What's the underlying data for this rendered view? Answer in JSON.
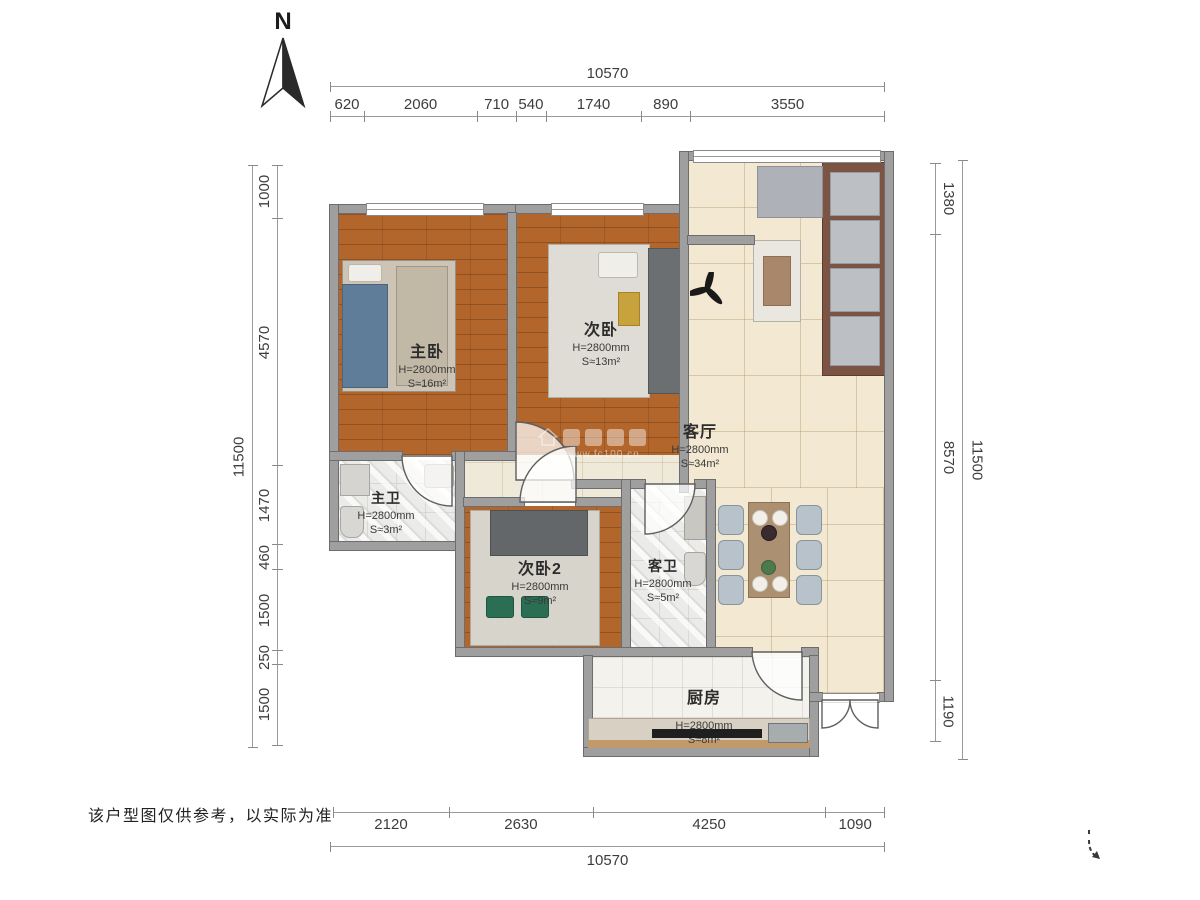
{
  "north": {
    "label": "N"
  },
  "disclaimer": "该户型图仅供参考，以实际为准",
  "watermark": {
    "url": "www.fc100.cn"
  },
  "dimensions": {
    "top": {
      "total": "10570",
      "segments": [
        620,
        2060,
        710,
        540,
        1740,
        890,
        3550
      ]
    },
    "bottom": {
      "total": "10570",
      "segments": [
        2120,
        2630,
        4250,
        1090
      ]
    },
    "left": {
      "total": "11500",
      "segments": [
        1000,
        4570,
        1470,
        460,
        1500,
        250,
        1500
      ]
    },
    "right": {
      "total": "11500",
      "segments": [
        1380,
        8570,
        1190
      ]
    }
  },
  "rooms": [
    {
      "id": "master-bedroom",
      "name": "主卧",
      "height": "H=2800mm",
      "area": "S≈16m²"
    },
    {
      "id": "bedroom-2",
      "name": "次卧",
      "height": "H=2800mm",
      "area": "S≈13m²"
    },
    {
      "id": "living-room",
      "name": "客厅",
      "height": "H=2800mm",
      "area": "S≈34m²"
    },
    {
      "id": "master-bath",
      "name": "主卫",
      "height": "H=2800mm",
      "area": "S≈3m²"
    },
    {
      "id": "bedroom-3",
      "name": "次卧2",
      "height": "H=2800mm",
      "area": "S≈9m²"
    },
    {
      "id": "guest-bath",
      "name": "客卫",
      "height": "H=2800mm",
      "area": "S≈5m²"
    },
    {
      "id": "kitchen",
      "name": "厨房",
      "height": "H=2800mm",
      "area": "S≈8m²"
    }
  ]
}
